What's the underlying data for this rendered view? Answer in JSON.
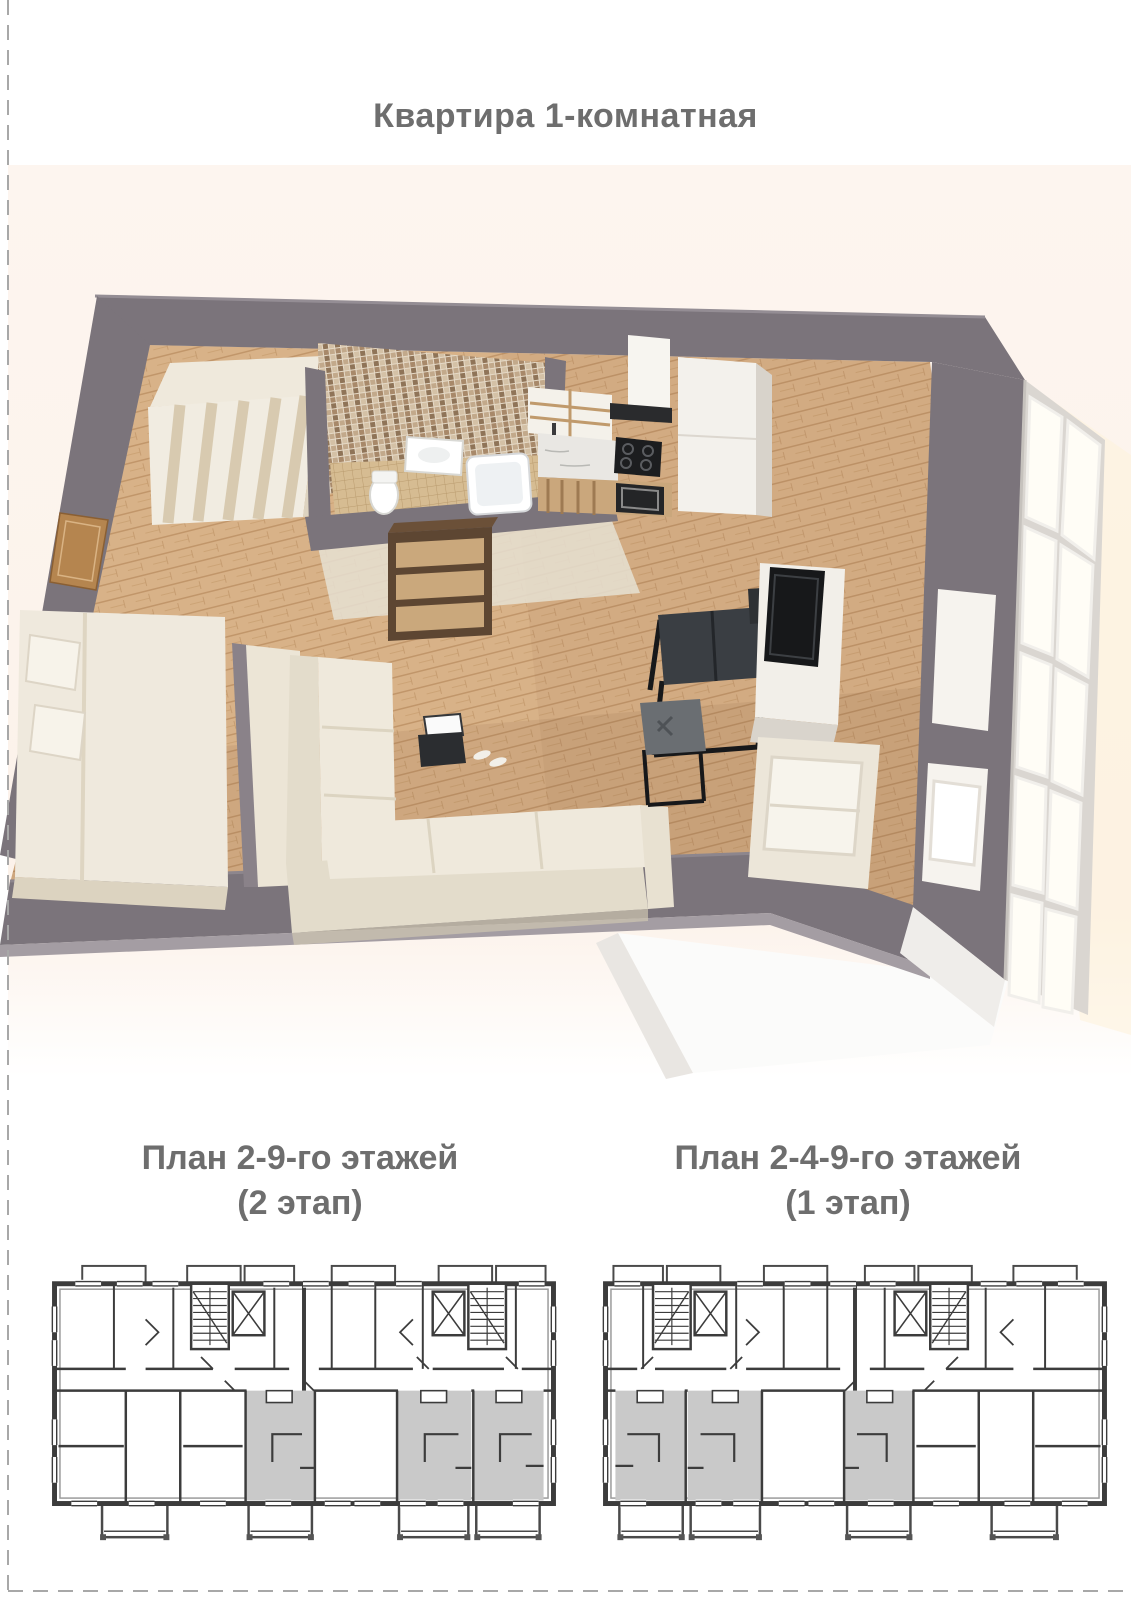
{
  "title": "Квартира 1-комнатная",
  "plans": {
    "left": {
      "line1": "План 2-9-го этажей",
      "line2": "(2 этап)"
    },
    "right": {
      "line1": "План 2-4-9-го этажей",
      "line2": "(1 этап)"
    }
  },
  "colors": {
    "page_background": "#ffffff",
    "heading_text": "#6e6e6e",
    "page_border_dash": "#a8a8a8",
    "render_backdrop": "#fdf4ee",
    "render_wall": "#7b747b",
    "render_floor_wood": "#d8b288",
    "plan_wall": "#3c3c3c",
    "plan_highlight": "#c9c9c9"
  }
}
